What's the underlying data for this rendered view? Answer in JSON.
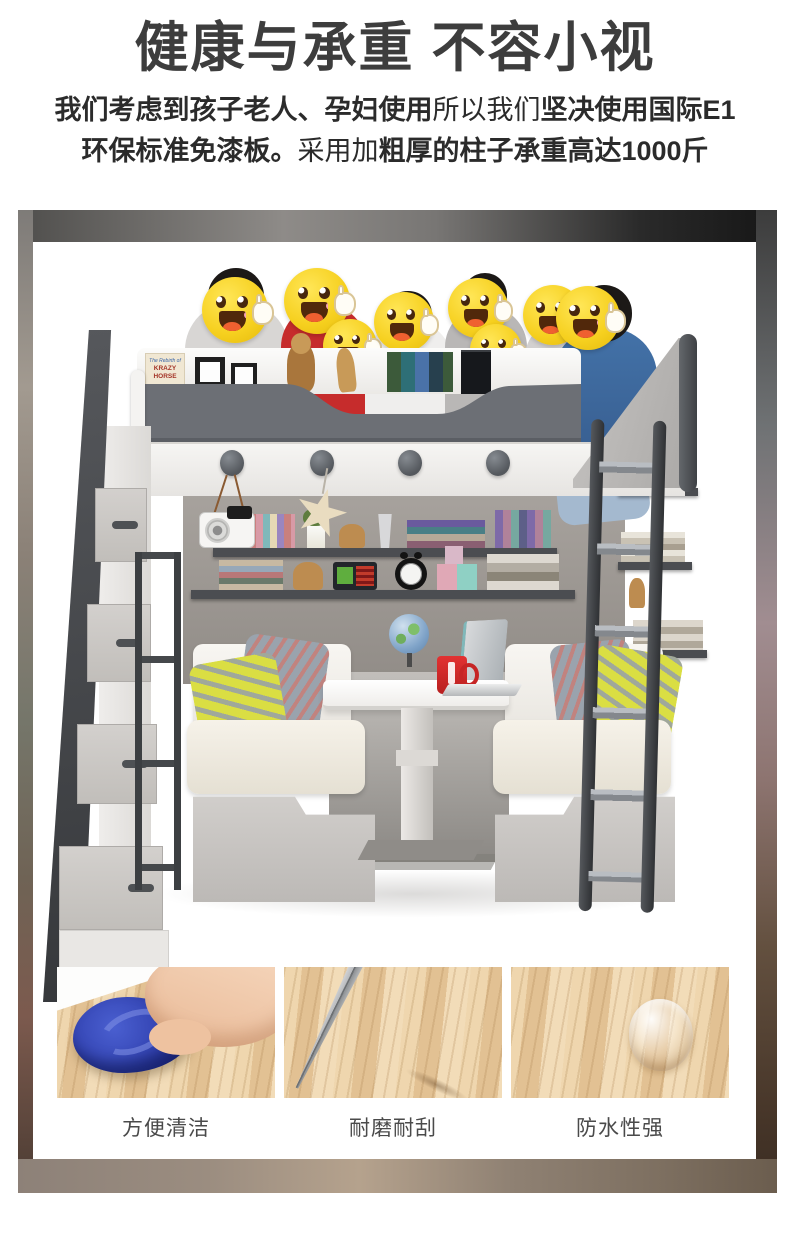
{
  "header": {
    "title": "健康与承重 不容小视",
    "subtitle": {
      "line1_bold1": "我们考虑到孩子老人、孕妇使用",
      "line1_regular": "所以我们",
      "line1_bold2": "坚决使用国际E1",
      "line2_bold1": "环保标准免漆板。",
      "line2_regular": "采用加",
      "line2_bold2": "粗厚的柱子承重高达1000斤"
    }
  },
  "product_photo": {
    "subject": "loft bunk bed with sofa benches, lift table and storage staircase; eight family members behind the upper bunk with thumbs-up smiley stickers over their faces",
    "sticker": "thumbs-up-smiley",
    "book_spine_small": "The Rebirth of",
    "book_spine_title": "KRAZY HORSE"
  },
  "features": {
    "items": [
      {
        "caption": "方便清洁",
        "photo": "blue cloth wiping wood surface"
      },
      {
        "caption": "耐磨耐刮",
        "photo": "metal blade tip on wood surface"
      },
      {
        "caption": "防水性强",
        "photo": "water drop on wood surface"
      }
    ]
  },
  "colors": {
    "title_text": "#3d3d3d",
    "body_text": "#2b2b2b",
    "emoji_yellow": "#f6d01f",
    "mug_red": "#d22828",
    "pillow_yellow": "#dade43",
    "rail_gray": "#6c6f75",
    "charcoal": "#3c3e42",
    "wood_beige": "#e9cda4"
  }
}
